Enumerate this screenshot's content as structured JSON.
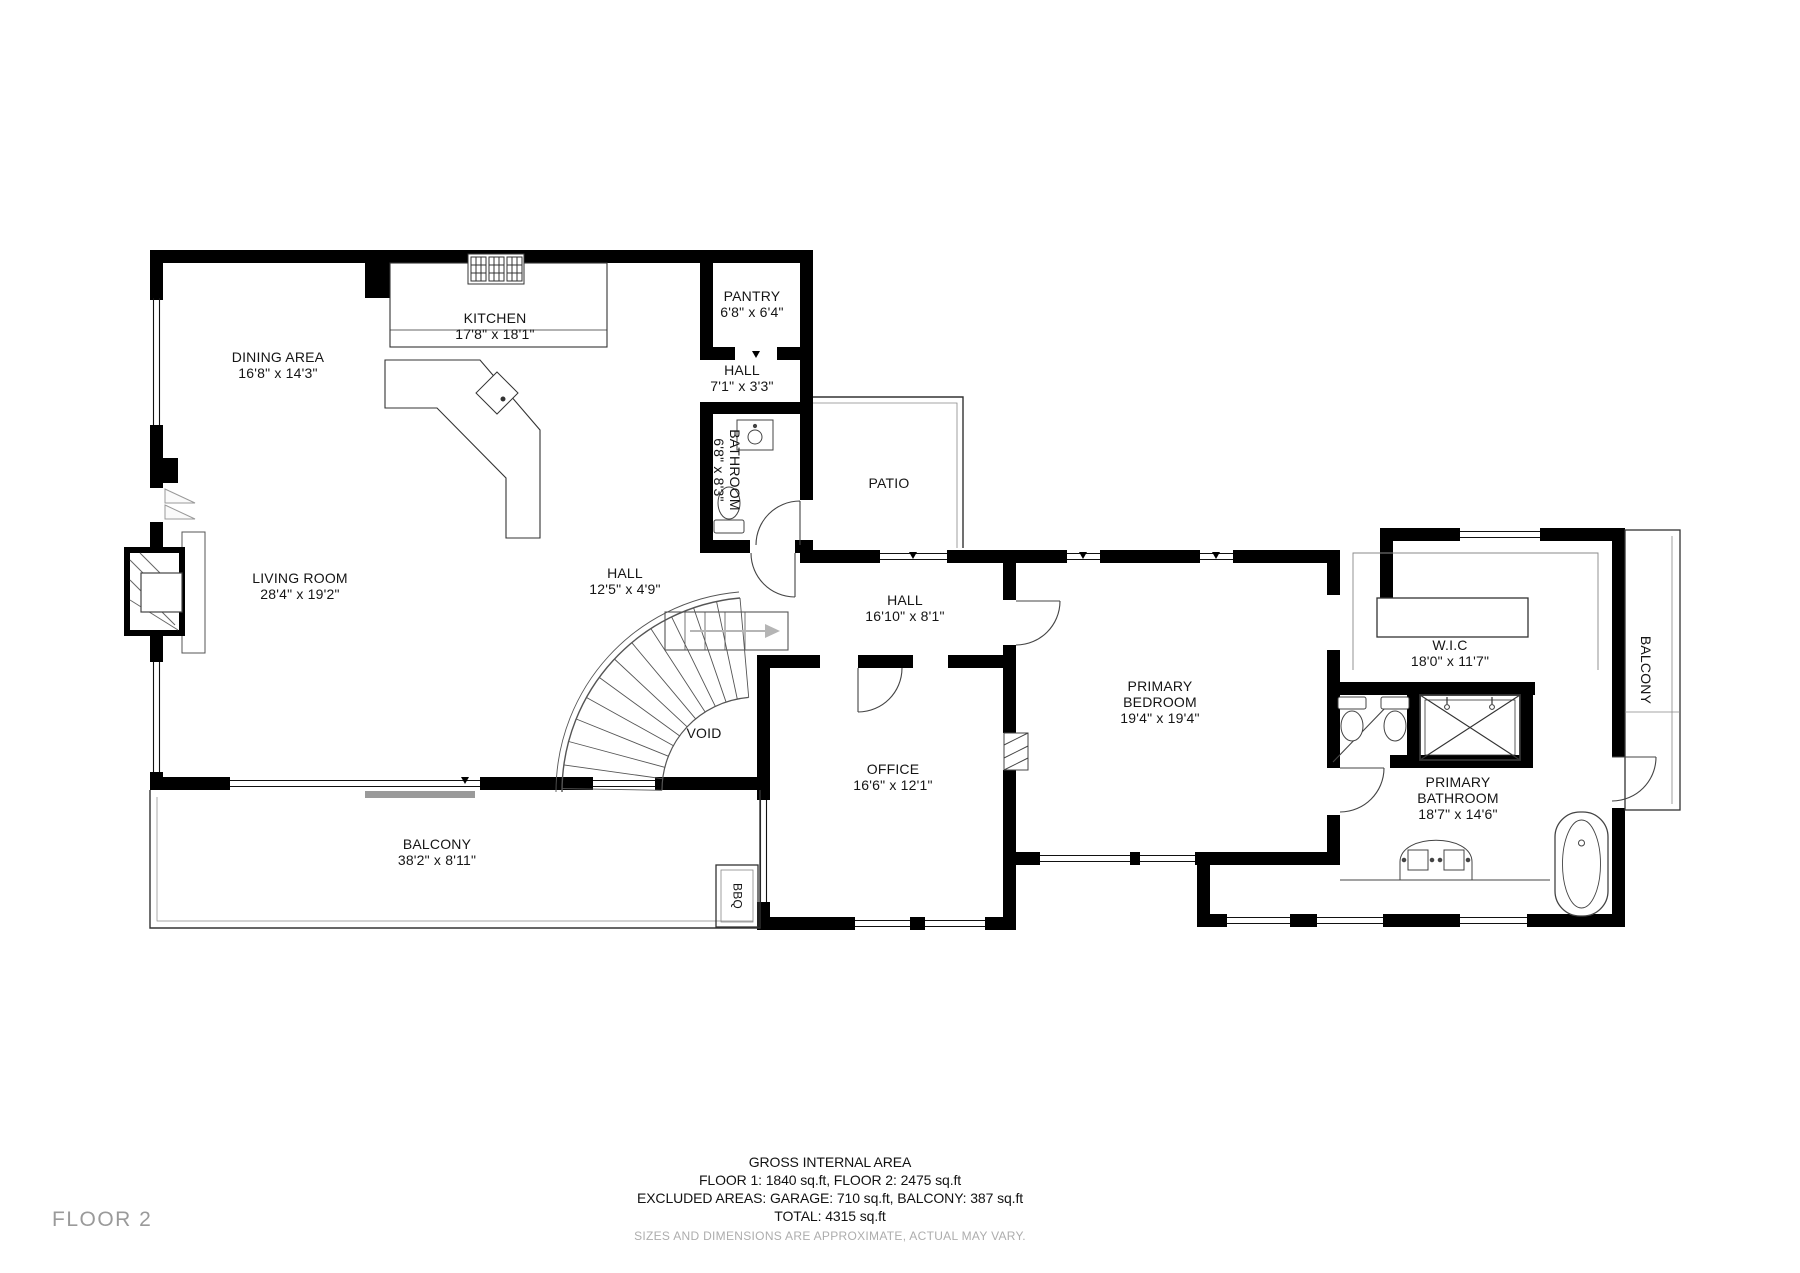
{
  "floor_label": "FLOOR 2",
  "rooms": {
    "kitchen": {
      "name": "KITCHEN",
      "dims": "17'8\" x 18'1\""
    },
    "dining": {
      "name": "DINING AREA",
      "dims": "16'8\" x 14'3\""
    },
    "pantry": {
      "name": "PANTRY",
      "dims": "6'8\" x 6'4\""
    },
    "hall_upper": {
      "name": "HALL",
      "dims": "7'1\" x 3'3\""
    },
    "bathroom": {
      "name": "BATHROOM",
      "dims": "6'8\" x 8'3\""
    },
    "patio": {
      "name": "PATIO",
      "dims": ""
    },
    "living": {
      "name": "LIVING ROOM",
      "dims": "28'4\" x 19'2\""
    },
    "hall_mid": {
      "name": "HALL",
      "dims": "12'5\" x 4'9\""
    },
    "hall_east": {
      "name": "HALL",
      "dims": "16'10\" x 8'1\""
    },
    "void": {
      "name": "VOID",
      "dims": ""
    },
    "office": {
      "name": "OFFICE",
      "dims": "16'6\" x 12'1\""
    },
    "primary_bedroom": {
      "name": "PRIMARY BEDROOM",
      "dims": "19'4\" x 19'4\""
    },
    "wic": {
      "name": "W.I.C",
      "dims": "18'0\" x 11'7\""
    },
    "balcony_right": {
      "name": "BALCONY",
      "dims": ""
    },
    "primary_bathroom": {
      "name": "PRIMARY BATHROOM",
      "dims": "18'7\" x 14'6\""
    },
    "balcony_bottom": {
      "name": "BALCONY",
      "dims": "38'2\" x 8'11\""
    },
    "bbq": {
      "name": "BBQ",
      "dims": ""
    }
  },
  "footer": {
    "title": "GROSS INTERNAL AREA",
    "line1": "FLOOR 1: 1840 sq.ft, FLOOR 2: 2475 sq.ft",
    "line2": "EXCLUDED AREAS: GARAGE: 710 sq.ft, BALCONY: 387 sq.ft",
    "total": "TOTAL: 4315 sq.ft",
    "disclaimer": "SIZES AND DIMENSIONS ARE APPROXIMATE, ACTUAL MAY VARY."
  },
  "colors": {
    "wall": "#000000",
    "background": "#ffffff",
    "muted_text": "#9a9a9a"
  }
}
